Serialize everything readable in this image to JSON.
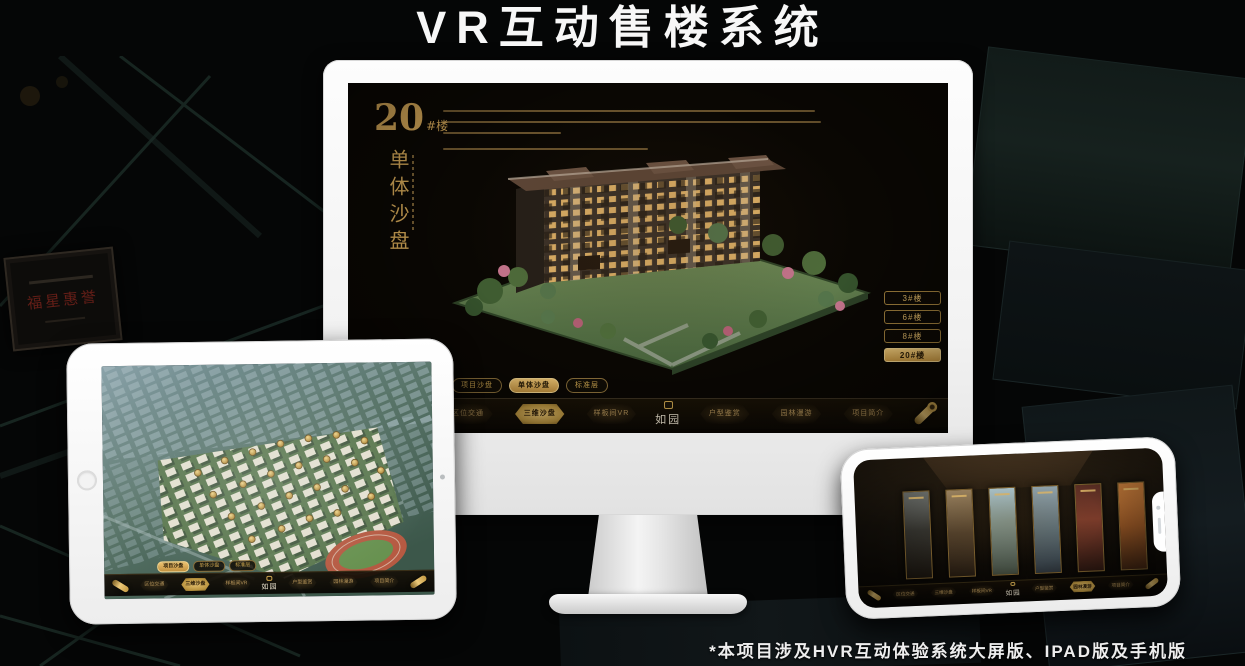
{
  "page": {
    "title": "VR互动售楼系统",
    "footnote": "*本项目涉及HVR互动体验系统大屏版、IPAD版及手机版",
    "background_plaque": "福星惠誉"
  },
  "colors": {
    "gold": "#c89b4a",
    "gold_bright": "#ecc372",
    "screen_bg": "#0a0703",
    "plaque_red": "#6e2019",
    "title_white": "#f7f7f7"
  },
  "icons": {
    "scroll": "scroll-icon (rolled gold scroll handle)",
    "seal": "seal-icon (square logo stamp)",
    "home": "home-button (tablet round button)",
    "camera": "camera-icon (front camera dot)"
  },
  "app": {
    "logo_text": "如园",
    "info_panel": {
      "number": "20",
      "suffix": "#楼",
      "subtitle": "单体沙盘"
    },
    "view_tabs": [
      {
        "label": "项目沙盘"
      },
      {
        "label": "单体沙盘"
      },
      {
        "label": "标准层"
      }
    ],
    "building_buttons": [
      {
        "label": "3#楼"
      },
      {
        "label": "6#楼"
      },
      {
        "label": "8#楼"
      },
      {
        "label": "20#楼"
      }
    ],
    "nav_items": [
      {
        "label": "区位交通"
      },
      {
        "label": "三维沙盘"
      },
      {
        "label": "样板间VR"
      },
      {
        "label": "户型鉴赏"
      },
      {
        "label": "园林漫游"
      },
      {
        "label": "项目简介"
      }
    ]
  },
  "devices": {
    "monitor": {
      "active_tab": "单体沙盘",
      "active_nav": "三维沙盘",
      "active_building": "20#楼"
    },
    "tablet": {
      "active_tab": "项目沙盘",
      "active_nav": "三维沙盘"
    },
    "phone": {
      "active_nav": "园林漫游"
    }
  }
}
